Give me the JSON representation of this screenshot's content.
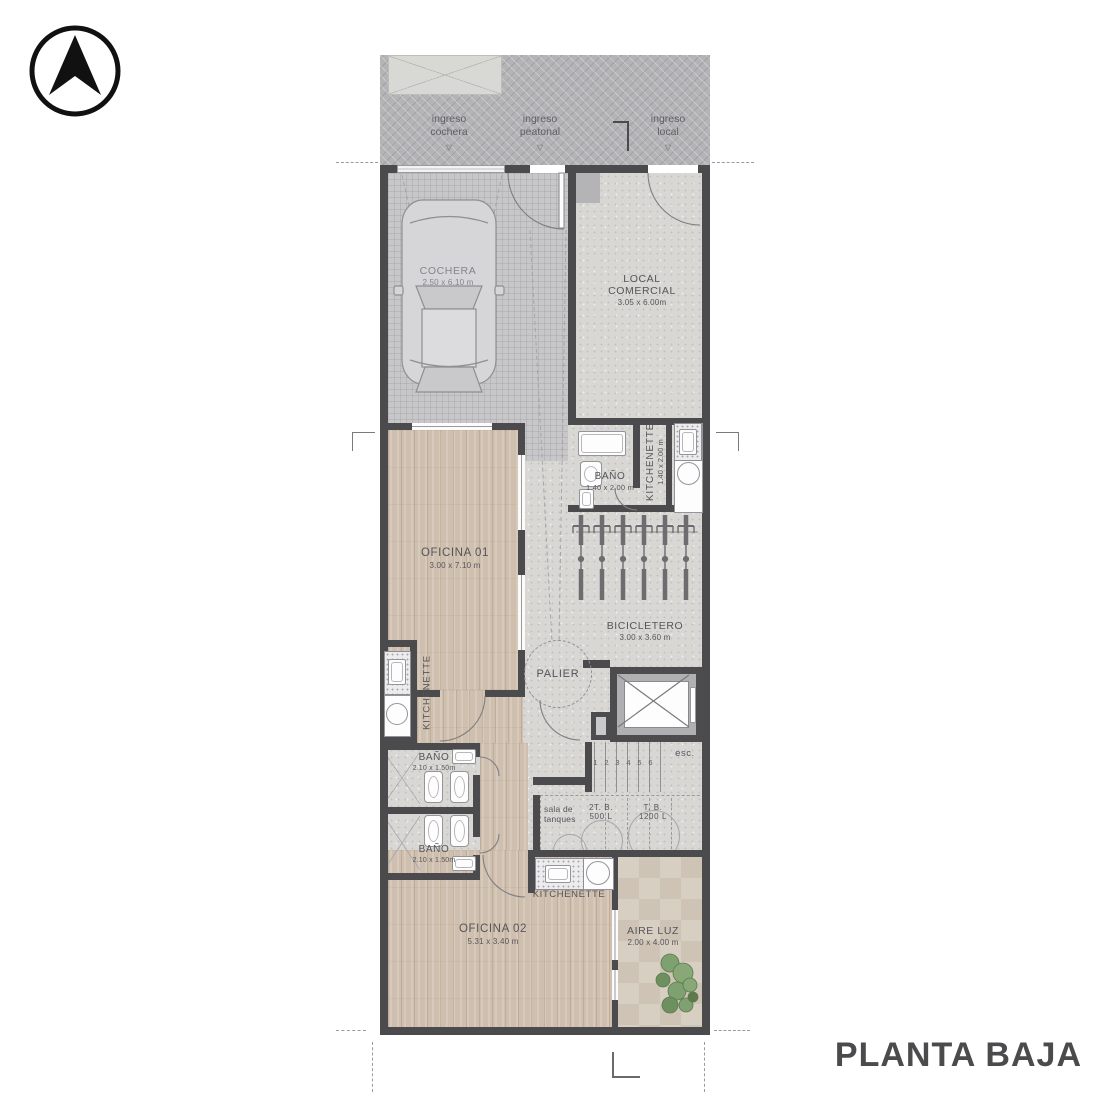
{
  "plan_title": "PLANTA BAJA",
  "glyphs": {
    "down_triangle": "▽"
  },
  "entrances": [
    {
      "line1": "ingreso",
      "line2": "cochera"
    },
    {
      "line1": "ingreso",
      "line2": "peatonal"
    },
    {
      "line1": "ingreso",
      "line2": "local"
    }
  ],
  "rooms": {
    "cochera": {
      "name": "COCHERA",
      "dims": "2.50 x 6.10 m"
    },
    "local_comercial": {
      "name": "LOCAL COMERCIAL",
      "dims": "3.05 x 6.00m"
    },
    "bano_local": {
      "name": "BAÑO",
      "dims": "1.40 x 2.00 m"
    },
    "kitchenette_local": {
      "name": "KITCHENETTE",
      "dims": "1.40 x 2.00 m"
    },
    "bicicletero": {
      "name": "BICICLETERO",
      "dims": "3.00 x 3.60 m"
    },
    "oficina_01": {
      "name": "OFICINA 01",
      "dims": "3.00 x 7.10 m"
    },
    "palier": {
      "name": "PALIER"
    },
    "kitchenette_oficina_01": {
      "name": "KITCHENETTE"
    },
    "bano_1": {
      "name": "BAÑO",
      "dims": "2.10 x 1.50m"
    },
    "bano_2": {
      "name": "BAÑO",
      "dims": "2.10 x 1.50m"
    },
    "kitchenette_oficina_02": {
      "name": "KITCHENETTE"
    },
    "oficina_02": {
      "name": "OFICINA 02",
      "dims": "5.31 x 3.40 m"
    },
    "aire_luz": {
      "name": "AIRE LUZ",
      "dims": "2.00 x 4.00 m"
    }
  },
  "stairs": {
    "label": "esc.",
    "numbers": [
      "1",
      "2",
      "3",
      "4",
      "5",
      "6"
    ]
  },
  "tanks": {
    "room_line1": "sala de",
    "room_line2": "tanques",
    "tank1_line1": "2T. B.",
    "tank1_line2": "500 L",
    "tank2_line1": "T. B.",
    "tank2_line2": "1200 L"
  },
  "colors": {
    "wall": "#4b4b4e",
    "text": "#55555a",
    "wood": "#cfbfae",
    "concrete": "#d8d7d4",
    "sidewalk": "#b4b4b7",
    "plant": "#7fa070"
  }
}
